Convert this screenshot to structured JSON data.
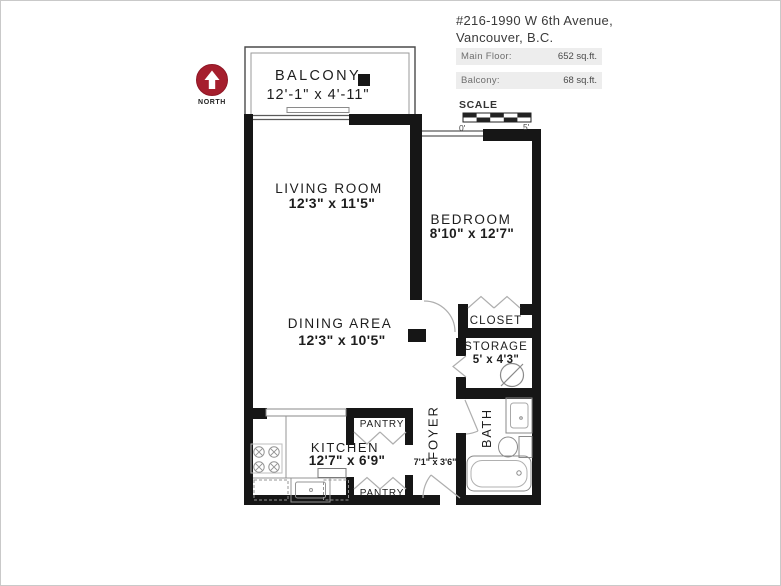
{
  "header": {
    "address_line1": "#216-1990 W 6th Avenue,",
    "address_line2": "Vancouver, B.C.",
    "areas": [
      {
        "label": "Main Floor:",
        "value": "652 sq.ft."
      },
      {
        "label": "Balcony:",
        "value": "68 sq.ft."
      }
    ]
  },
  "scale": {
    "title": "SCALE",
    "start_label": "0'",
    "end_label": "5'"
  },
  "north": {
    "label": "NORTH"
  },
  "rooms": {
    "balcony": {
      "name": "BALCONY",
      "dims": "12'-1\" x 4'-11\""
    },
    "living_room": {
      "name": "LIVING ROOM",
      "dims": "12'3\" x 11'5\""
    },
    "bedroom": {
      "name": "BEDROOM",
      "dims": "8'10\" x 12'7\""
    },
    "dining_area": {
      "name": "DINING AREA",
      "dims": "12'3\" x 10'5\""
    },
    "kitchen": {
      "name": "KITCHEN",
      "dims": "12'7\" x 6'9\""
    },
    "foyer": {
      "name": "FOYER",
      "dims": "7'1\" x 3'6\""
    },
    "bath": {
      "name": "BATH"
    },
    "closet": {
      "name": "CLOSET"
    },
    "storage": {
      "name": "STORAGE",
      "dims": "5' x 4'3\""
    },
    "pantry_top": {
      "name": "PANTRY"
    },
    "pantry_bottom": {
      "name": "PANTRY"
    }
  },
  "colors": {
    "wall": "#161616",
    "north_badge": "#a51e2d",
    "header_bar_bg": "#ededed",
    "fixture_line": "#949494"
  }
}
